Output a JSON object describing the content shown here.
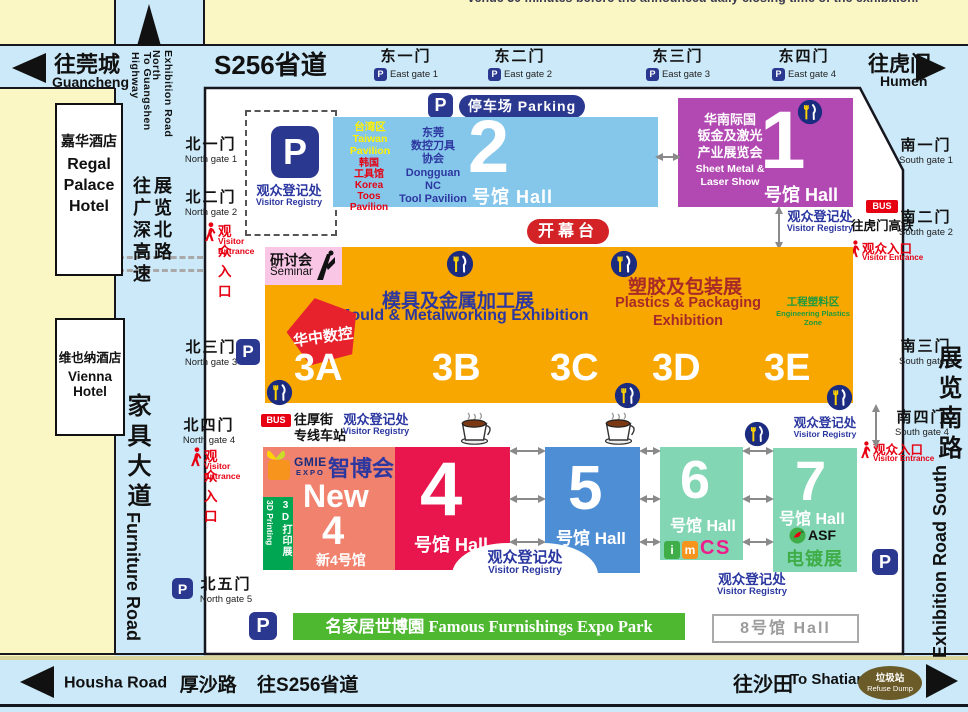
{
  "top_note": "venue 30 minutes before the announced daily closing time of the exhibition.",
  "roads": {
    "s256": "S256省道",
    "guancheng_zh": "往莞城",
    "guancheng_en": "Guancheng",
    "humen_zh": "往虎门",
    "humen_en": "Humen",
    "exh_north_en": "Exhibition Road North",
    "guangshen_en": "To Guangshen Highway",
    "exh_north_zh": "展览北路",
    "guangshen_zh": "往广深高速",
    "furniture_zh": "家具大道",
    "furniture_en": "Furniture Road",
    "exh_south_zh": "展览南路",
    "exh_south_en": "Exhibition Road South",
    "housha_en": "Housha Road",
    "housha_zh": "厚沙路",
    "housha_s256": "往S256省道",
    "shatian_zh": "往沙田",
    "shatian_en": "To Shatian",
    "refuse_zh": "垃圾站",
    "refuse_en": "Refuse Dump"
  },
  "hotels": {
    "regal_zh": "嘉华酒店",
    "regal_en": "Regal\nPalace\nHotel",
    "vienna_zh": "维也纳酒店",
    "vienna_en": "Vienna Hotel"
  },
  "gates": {
    "north": [
      {
        "zh": "北一门",
        "en": "North gate 1"
      },
      {
        "zh": "北二门",
        "en": "North gate 2"
      },
      {
        "zh": "北三门",
        "en": "North gate 3"
      },
      {
        "zh": "北四门",
        "en": "North gate 4"
      },
      {
        "zh": "北五门",
        "en": "North gate 5"
      }
    ],
    "east": [
      {
        "zh": "东一门",
        "en": "East gate 1"
      },
      {
        "zh": "东二门",
        "en": "East gate 2"
      },
      {
        "zh": "东三门",
        "en": "East gate 3"
      },
      {
        "zh": "东四门",
        "en": "East gate 4"
      }
    ],
    "south": [
      {
        "zh": "南一门",
        "en": "South gate 1"
      },
      {
        "zh": "南二门",
        "en": "South gate 2"
      },
      {
        "zh": "南三门",
        "en": "South gate 3"
      },
      {
        "zh": "南四门",
        "en": "South gate 4"
      }
    ]
  },
  "labels": {
    "registry_zh": "观众登记处",
    "registry_en": "Visitor Registry",
    "entrance_zh": "观众入口",
    "entrance_en": "Visitor Entrance",
    "parking": "停车场 Parking",
    "p": "P",
    "bus": "BUS",
    "bus_humen_rail": "往虎门高铁",
    "bus_houjie": "往厚街\n专线车站",
    "opening_stage": "开幕台"
  },
  "halls": {
    "h1": {
      "num": "1",
      "hall": "号馆 Hall",
      "title_zh": "华南际国\n钣金及激光\n产业展览会",
      "title_en": "Sheet Metal &\nLaser Show"
    },
    "h2": {
      "num": "2",
      "hall": "号馆 Hall",
      "taiwan": "台湾区\nTaiwan\nPavilion",
      "korea": "韩国\n工具馆\nKorea\nToos Pavilion",
      "dongguan": "东莞\n数控刀具\n协会\nDongguan NC\nTool Pavilion"
    },
    "h3": {
      "mould_zh": "模具及金属加工展",
      "mould_en": "Mould & Metalworking Exhibition",
      "plastics_zh": "塑胶及包装展",
      "plastics_en": "Plastics & Packaging\nExhibition",
      "eng_zh": "工程塑料区",
      "eng_en": "Engineering Plastics\nZone",
      "seminar_zh": "研讨会",
      "seminar_en": "Seminar",
      "pentagon": "华中数控",
      "sections": [
        "3A",
        "3B",
        "3C",
        "3D",
        "3E"
      ]
    },
    "new4": {
      "logo_top": "GMIE",
      "logo_sub": "EXPO",
      "zhibohui": "智博会",
      "new_label": "New",
      "num": "4",
      "sub": "新4号馆",
      "strip_zh": "3D打印展",
      "strip_en": "3D Printing"
    },
    "h4": {
      "num": "4",
      "hall": "号馆 Hall"
    },
    "h5": {
      "num": "5",
      "hall": "号馆 Hall"
    },
    "h6": {
      "num": "6",
      "hall": "号馆 Hall",
      "logo": [
        "i",
        "m",
        "C",
        "S"
      ]
    },
    "h7": {
      "num": "7",
      "hall": "号馆 Hall",
      "asf": "ASF",
      "plating": "电镀展"
    },
    "h8": {
      "label": "8号馆 Hall"
    }
  },
  "expo_park": "名家居世博園 Famous Furnishings Expo Park",
  "colors": {
    "background": "#FBF7C5",
    "road": "#CBE9F8",
    "hall1": "#B248B2",
    "hall2": "#85C6EB",
    "hall3": "#F8A701",
    "hall4": "#E8164C",
    "new4": "#F0826E",
    "hall5": "#4E8ED5",
    "hall6": "#82D6B4",
    "hall7": "#82D6B4",
    "banner_green": "#4DB830",
    "strip_green": "#00A651",
    "p_blue": "#2A3890",
    "registry_blue": "#2B37A0",
    "entrance_red": "#E60012",
    "stage_red": "#D32327",
    "seminar_pink": "#F9C6E6",
    "pentagon_red": "#E8222D",
    "refuse_olive": "#6B5B28"
  }
}
